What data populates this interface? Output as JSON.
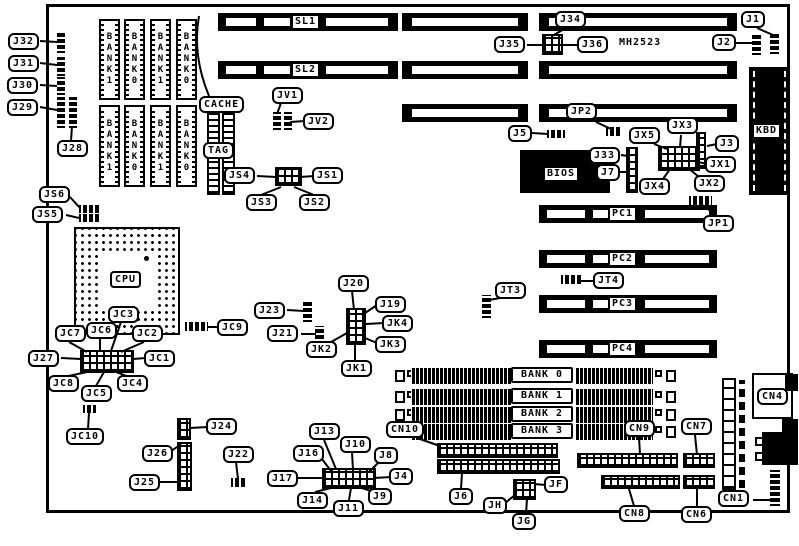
{
  "board": {
    "model": "MH2523",
    "slots": {
      "sl1": "SL1",
      "sl2": "SL2",
      "pc1": "PC1",
      "pc2": "PC2",
      "pc3": "PC3",
      "pc4": "PC4"
    },
    "memory_banks": [
      "BANK 0",
      "BANK 1",
      "BANK 2",
      "BANK 3"
    ],
    "cache": {
      "cache_label": "CACHE",
      "tag_label": "TAG",
      "sram_row1": [
        "BANK1",
        "BANK0",
        "BANK1",
        "BANK0"
      ],
      "sram_row2": [
        "BANK1",
        "BANK0",
        "BANK1",
        "BANK0"
      ]
    },
    "chips": {
      "cpu": "CPU",
      "bios": "BIOS",
      "kbd": "KBD"
    },
    "callouts": {
      "j1": "J1",
      "j2": "J2",
      "j3": "J3",
      "j4": "J4",
      "j5": "J5",
      "j6": "J6",
      "j7": "J7",
      "j8": "J8",
      "j9": "J9",
      "j10": "J10",
      "j11": "J11",
      "j13": "J13",
      "j14": "J14",
      "j16": "J16",
      "j17": "J17",
      "j19": "J19",
      "j20": "J20",
      "j21": "J21",
      "j22": "J22",
      "j23": "J23",
      "j24": "J24",
      "j25": "J25",
      "j26": "J26",
      "j27": "J27",
      "j28": "J28",
      "j29": "J29",
      "j30": "J30",
      "j31": "J31",
      "j32": "J32",
      "j33": "J33",
      "j34": "J34",
      "j35": "J35",
      "j36": "J36",
      "jp1": "JP1",
      "jp2": "JP2",
      "jt3": "JT3",
      "jt4": "JT4",
      "jv1": "JV1",
      "jv2": "JV2",
      "js1": "JS1",
      "js2": "JS2",
      "js3": "JS3",
      "js4": "JS4",
      "js5": "JS5",
      "js6": "JS6",
      "jx1": "JX1",
      "jx2": "JX2",
      "jx3": "JX3",
      "jx4": "JX4",
      "jx5": "JX5",
      "jc1": "JC1",
      "jc2": "JC2",
      "jc3": "JC3",
      "jc4": "JC4",
      "jc5": "JC5",
      "jc6": "JC6",
      "jc7": "JC7",
      "jc8": "JC8",
      "jc9": "JC9",
      "jc10": "JC10",
      "jk1": "JK1",
      "jk2": "JK2",
      "jk3": "JK3",
      "jk4": "JK4",
      "jh": "JH",
      "jg": "JG",
      "jf": "JF",
      "cn1": "CN1",
      "cn4": "CN4",
      "cn6": "CN6",
      "cn7": "CN7",
      "cn8": "CN8",
      "cn9": "CN9",
      "cn10": "CN10"
    }
  }
}
